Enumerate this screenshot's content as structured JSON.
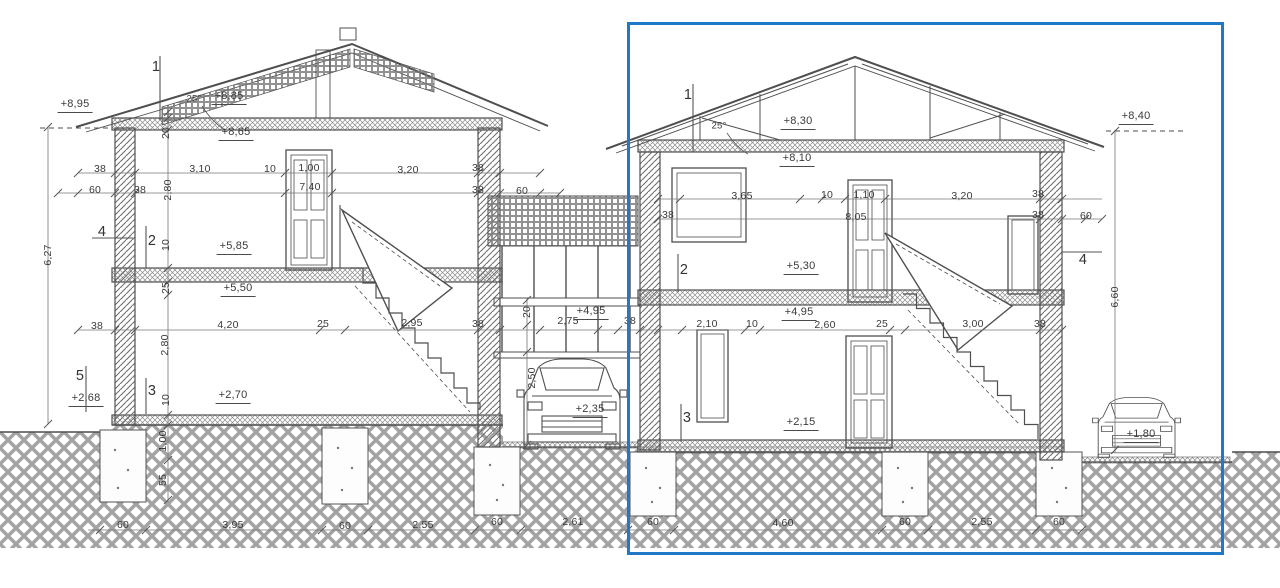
{
  "drawing": {
    "type": "building-cross-section",
    "highlight_color": "#1f79c8",
    "line_color": "#4f4f4f"
  },
  "labels": {
    "elevations": [
      {
        "text": "+8,95",
        "x": 75,
        "y": 106
      },
      {
        "text": "+8,85",
        "x": 229,
        "y": 98
      },
      {
        "text": "+8,65",
        "x": 236,
        "y": 134
      },
      {
        "text": "+5,85",
        "x": 234,
        "y": 248
      },
      {
        "text": "+5,50",
        "x": 238,
        "y": 290
      },
      {
        "text": "+2,70",
        "x": 233,
        "y": 397
      },
      {
        "text": "+2,68",
        "x": 86,
        "y": 400
      },
      {
        "text": "+4,95",
        "x": 591,
        "y": 313
      },
      {
        "text": "+2,35",
        "x": 590,
        "y": 411
      },
      {
        "text": "+8,30",
        "x": 798,
        "y": 123
      },
      {
        "text": "+8,10",
        "x": 797,
        "y": 160
      },
      {
        "text": "+8,40",
        "x": 1136,
        "y": 118
      },
      {
        "text": "+5,30",
        "x": 801,
        "y": 268
      },
      {
        "text": "+4,95",
        "x": 799,
        "y": 314
      },
      {
        "text": "+2,15",
        "x": 801,
        "y": 424
      },
      {
        "text": "+1,80",
        "x": 1141,
        "y": 436
      }
    ],
    "dims_h": [
      {
        "text": "38",
        "x": 100,
        "y": 169
      },
      {
        "text": "3,10",
        "x": 200,
        "y": 169
      },
      {
        "text": "10",
        "x": 270,
        "y": 169
      },
      {
        "text": "1,00",
        "x": 309,
        "y": 168
      },
      {
        "text": "3,20",
        "x": 408,
        "y": 170
      },
      {
        "text": "38",
        "x": 478,
        "y": 168
      },
      {
        "text": "60",
        "x": 95,
        "y": 190
      },
      {
        "text": "38",
        "x": 140,
        "y": 190
      },
      {
        "text": "7,40",
        "x": 310,
        "y": 187
      },
      {
        "text": "38",
        "x": 478,
        "y": 190
      },
      {
        "text": "60",
        "x": 522,
        "y": 191
      },
      {
        "text": "38",
        "x": 97,
        "y": 326
      },
      {
        "text": "4,20",
        "x": 228,
        "y": 325
      },
      {
        "text": "25",
        "x": 323,
        "y": 324
      },
      {
        "text": "2,95",
        "x": 412,
        "y": 323
      },
      {
        "text": "38",
        "x": 478,
        "y": 324
      },
      {
        "text": "2,75",
        "x": 568,
        "y": 321
      },
      {
        "text": "38",
        "x": 630,
        "y": 321
      },
      {
        "text": "3,65",
        "x": 742,
        "y": 196
      },
      {
        "text": "10",
        "x": 827,
        "y": 195
      },
      {
        "text": "1,10",
        "x": 864,
        "y": 195
      },
      {
        "text": "3,20",
        "x": 962,
        "y": 196
      },
      {
        "text": "38",
        "x": 1038,
        "y": 194
      },
      {
        "text": "38",
        "x": 668,
        "y": 215
      },
      {
        "text": "8,05",
        "x": 856,
        "y": 217
      },
      {
        "text": "38",
        "x": 1038,
        "y": 215
      },
      {
        "text": "60",
        "x": 1086,
        "y": 216
      },
      {
        "text": "2,10",
        "x": 707,
        "y": 324
      },
      {
        "text": "10",
        "x": 752,
        "y": 324
      },
      {
        "text": "2,60",
        "x": 825,
        "y": 325
      },
      {
        "text": "25",
        "x": 882,
        "y": 324
      },
      {
        "text": "3,00",
        "x": 973,
        "y": 324
      },
      {
        "text": "38",
        "x": 1040,
        "y": 324
      },
      {
        "text": "60",
        "x": 123,
        "y": 525
      },
      {
        "text": "3,95",
        "x": 233,
        "y": 525
      },
      {
        "text": "60",
        "x": 345,
        "y": 526
      },
      {
        "text": "2,55",
        "x": 423,
        "y": 525
      },
      {
        "text": "60",
        "x": 497,
        "y": 522
      },
      {
        "text": "2,61",
        "x": 573,
        "y": 522
      },
      {
        "text": "60",
        "x": 653,
        "y": 522
      },
      {
        "text": "4,60",
        "x": 783,
        "y": 523
      },
      {
        "text": "60",
        "x": 905,
        "y": 522
      },
      {
        "text": "2,55",
        "x": 982,
        "y": 522
      },
      {
        "text": "60",
        "x": 1059,
        "y": 522
      }
    ],
    "dims_v": [
      {
        "text": "6,27",
        "x": 48,
        "y": 255
      },
      {
        "text": "20",
        "x": 166,
        "y": 133
      },
      {
        "text": "2,80",
        "x": 168,
        "y": 190
      },
      {
        "text": "10",
        "x": 166,
        "y": 245
      },
      {
        "text": "25",
        "x": 166,
        "y": 288
      },
      {
        "text": "2,80",
        "x": 165,
        "y": 345
      },
      {
        "text": "10",
        "x": 166,
        "y": 400
      },
      {
        "text": "1,00",
        "x": 163,
        "y": 441
      },
      {
        "text": "55",
        "x": 163,
        "y": 480
      },
      {
        "text": "20",
        "x": 527,
        "y": 312
      },
      {
        "text": "2,50",
        "x": 532,
        "y": 378
      },
      {
        "text": "6,60",
        "x": 1115,
        "y": 297
      }
    ],
    "markers": [
      {
        "text": "1",
        "x": 156,
        "y": 67
      },
      {
        "text": "4",
        "x": 102,
        "y": 232
      },
      {
        "text": "2",
        "x": 152,
        "y": 241
      },
      {
        "text": "5",
        "x": 80,
        "y": 376
      },
      {
        "text": "3",
        "x": 152,
        "y": 391
      },
      {
        "text": "1",
        "x": 688,
        "y": 95
      },
      {
        "text": "2",
        "x": 684,
        "y": 270
      },
      {
        "text": "3",
        "x": 687,
        "y": 418
      },
      {
        "text": "4",
        "x": 1083,
        "y": 260
      }
    ],
    "angles": [
      {
        "text": "25°",
        "x": 194,
        "y": 99
      },
      {
        "text": "25°",
        "x": 719,
        "y": 126
      }
    ]
  }
}
